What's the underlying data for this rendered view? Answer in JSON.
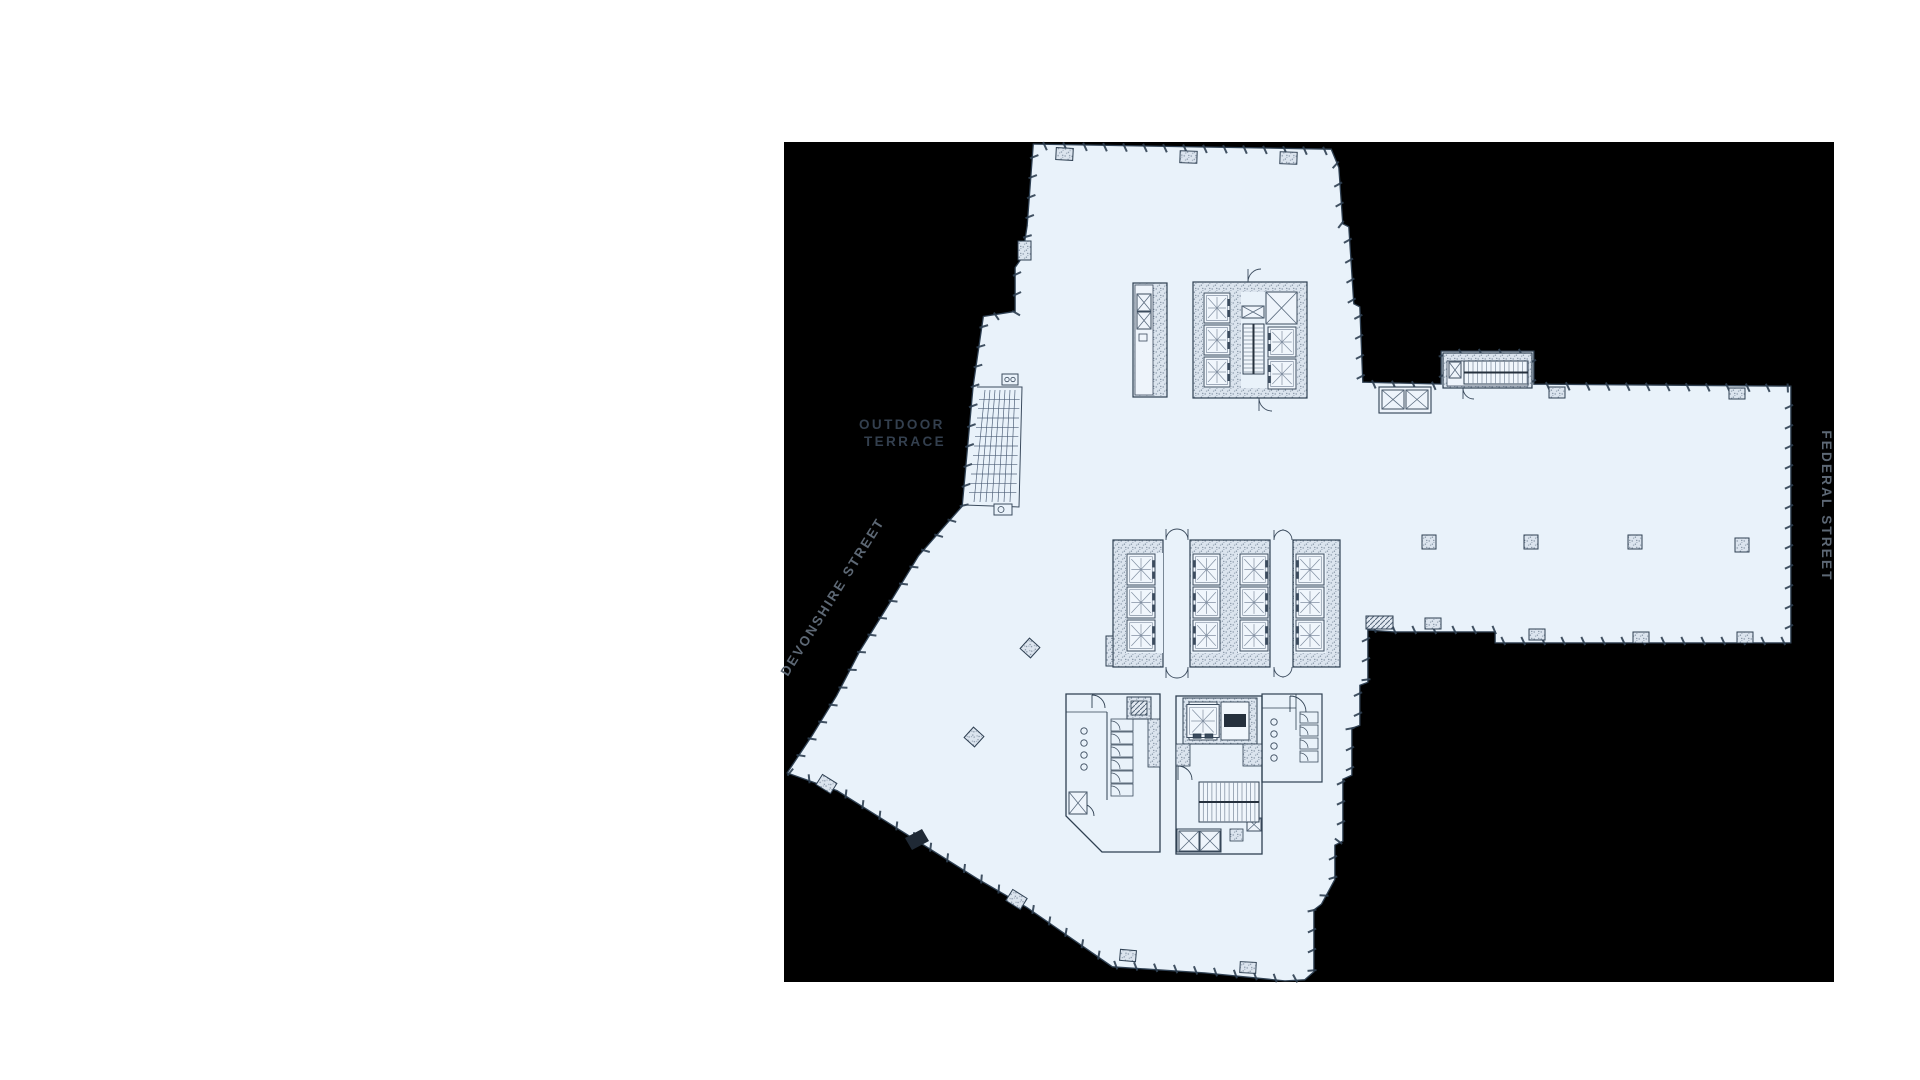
{
  "page": {
    "background_color": "#ffffff"
  },
  "plan_canvas": {
    "background_color": "#000000",
    "floor_fill_color": "#e9f2fa",
    "wall_line_color": "#2f4052",
    "detail_line_color": "#7b8a9c",
    "cab_fill_color": "#f0f6fc",
    "labels": {
      "outdoor_terrace": {
        "line1": "OUTDOOR",
        "line2": "TERRACE",
        "color": "#333f4e"
      },
      "devonshire_street": {
        "text": "DEVONSHIRE STREET",
        "color": "#5d6875"
      },
      "federal_street": {
        "text": "FEDERAL STREET",
        "color": "#5d6875"
      }
    }
  }
}
